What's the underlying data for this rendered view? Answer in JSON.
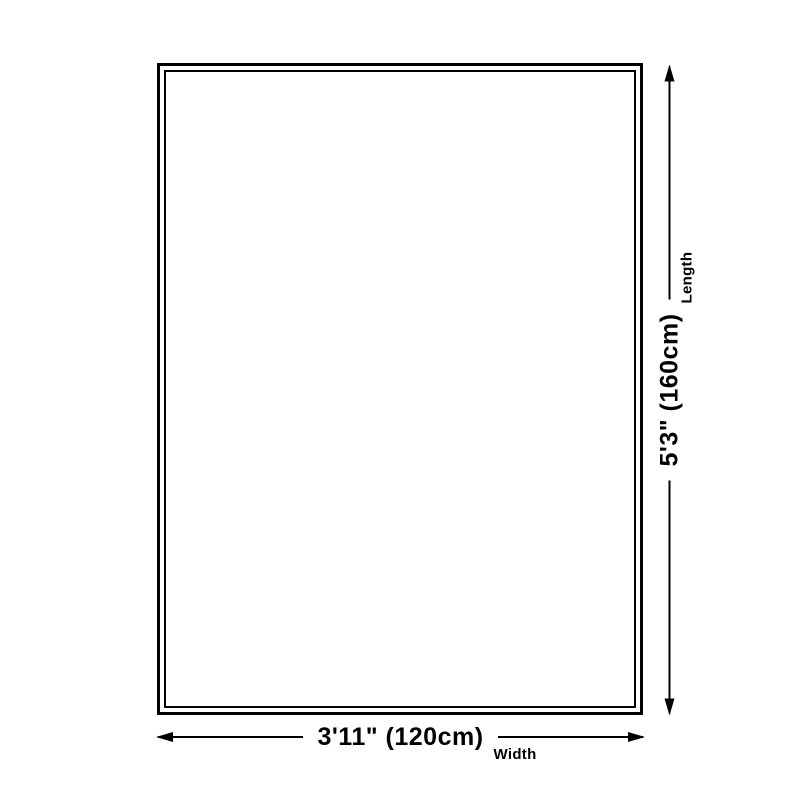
{
  "diagram": {
    "title": "product-size-diagram",
    "width_dim": {
      "value": "3'11\" (120cm)",
      "label": "Width"
    },
    "length_dim": {
      "value": "5'3\" (160cm)",
      "label": "Length"
    }
  },
  "colors": {
    "line": "#000000",
    "text": "#000000",
    "background": "#ffffff"
  }
}
